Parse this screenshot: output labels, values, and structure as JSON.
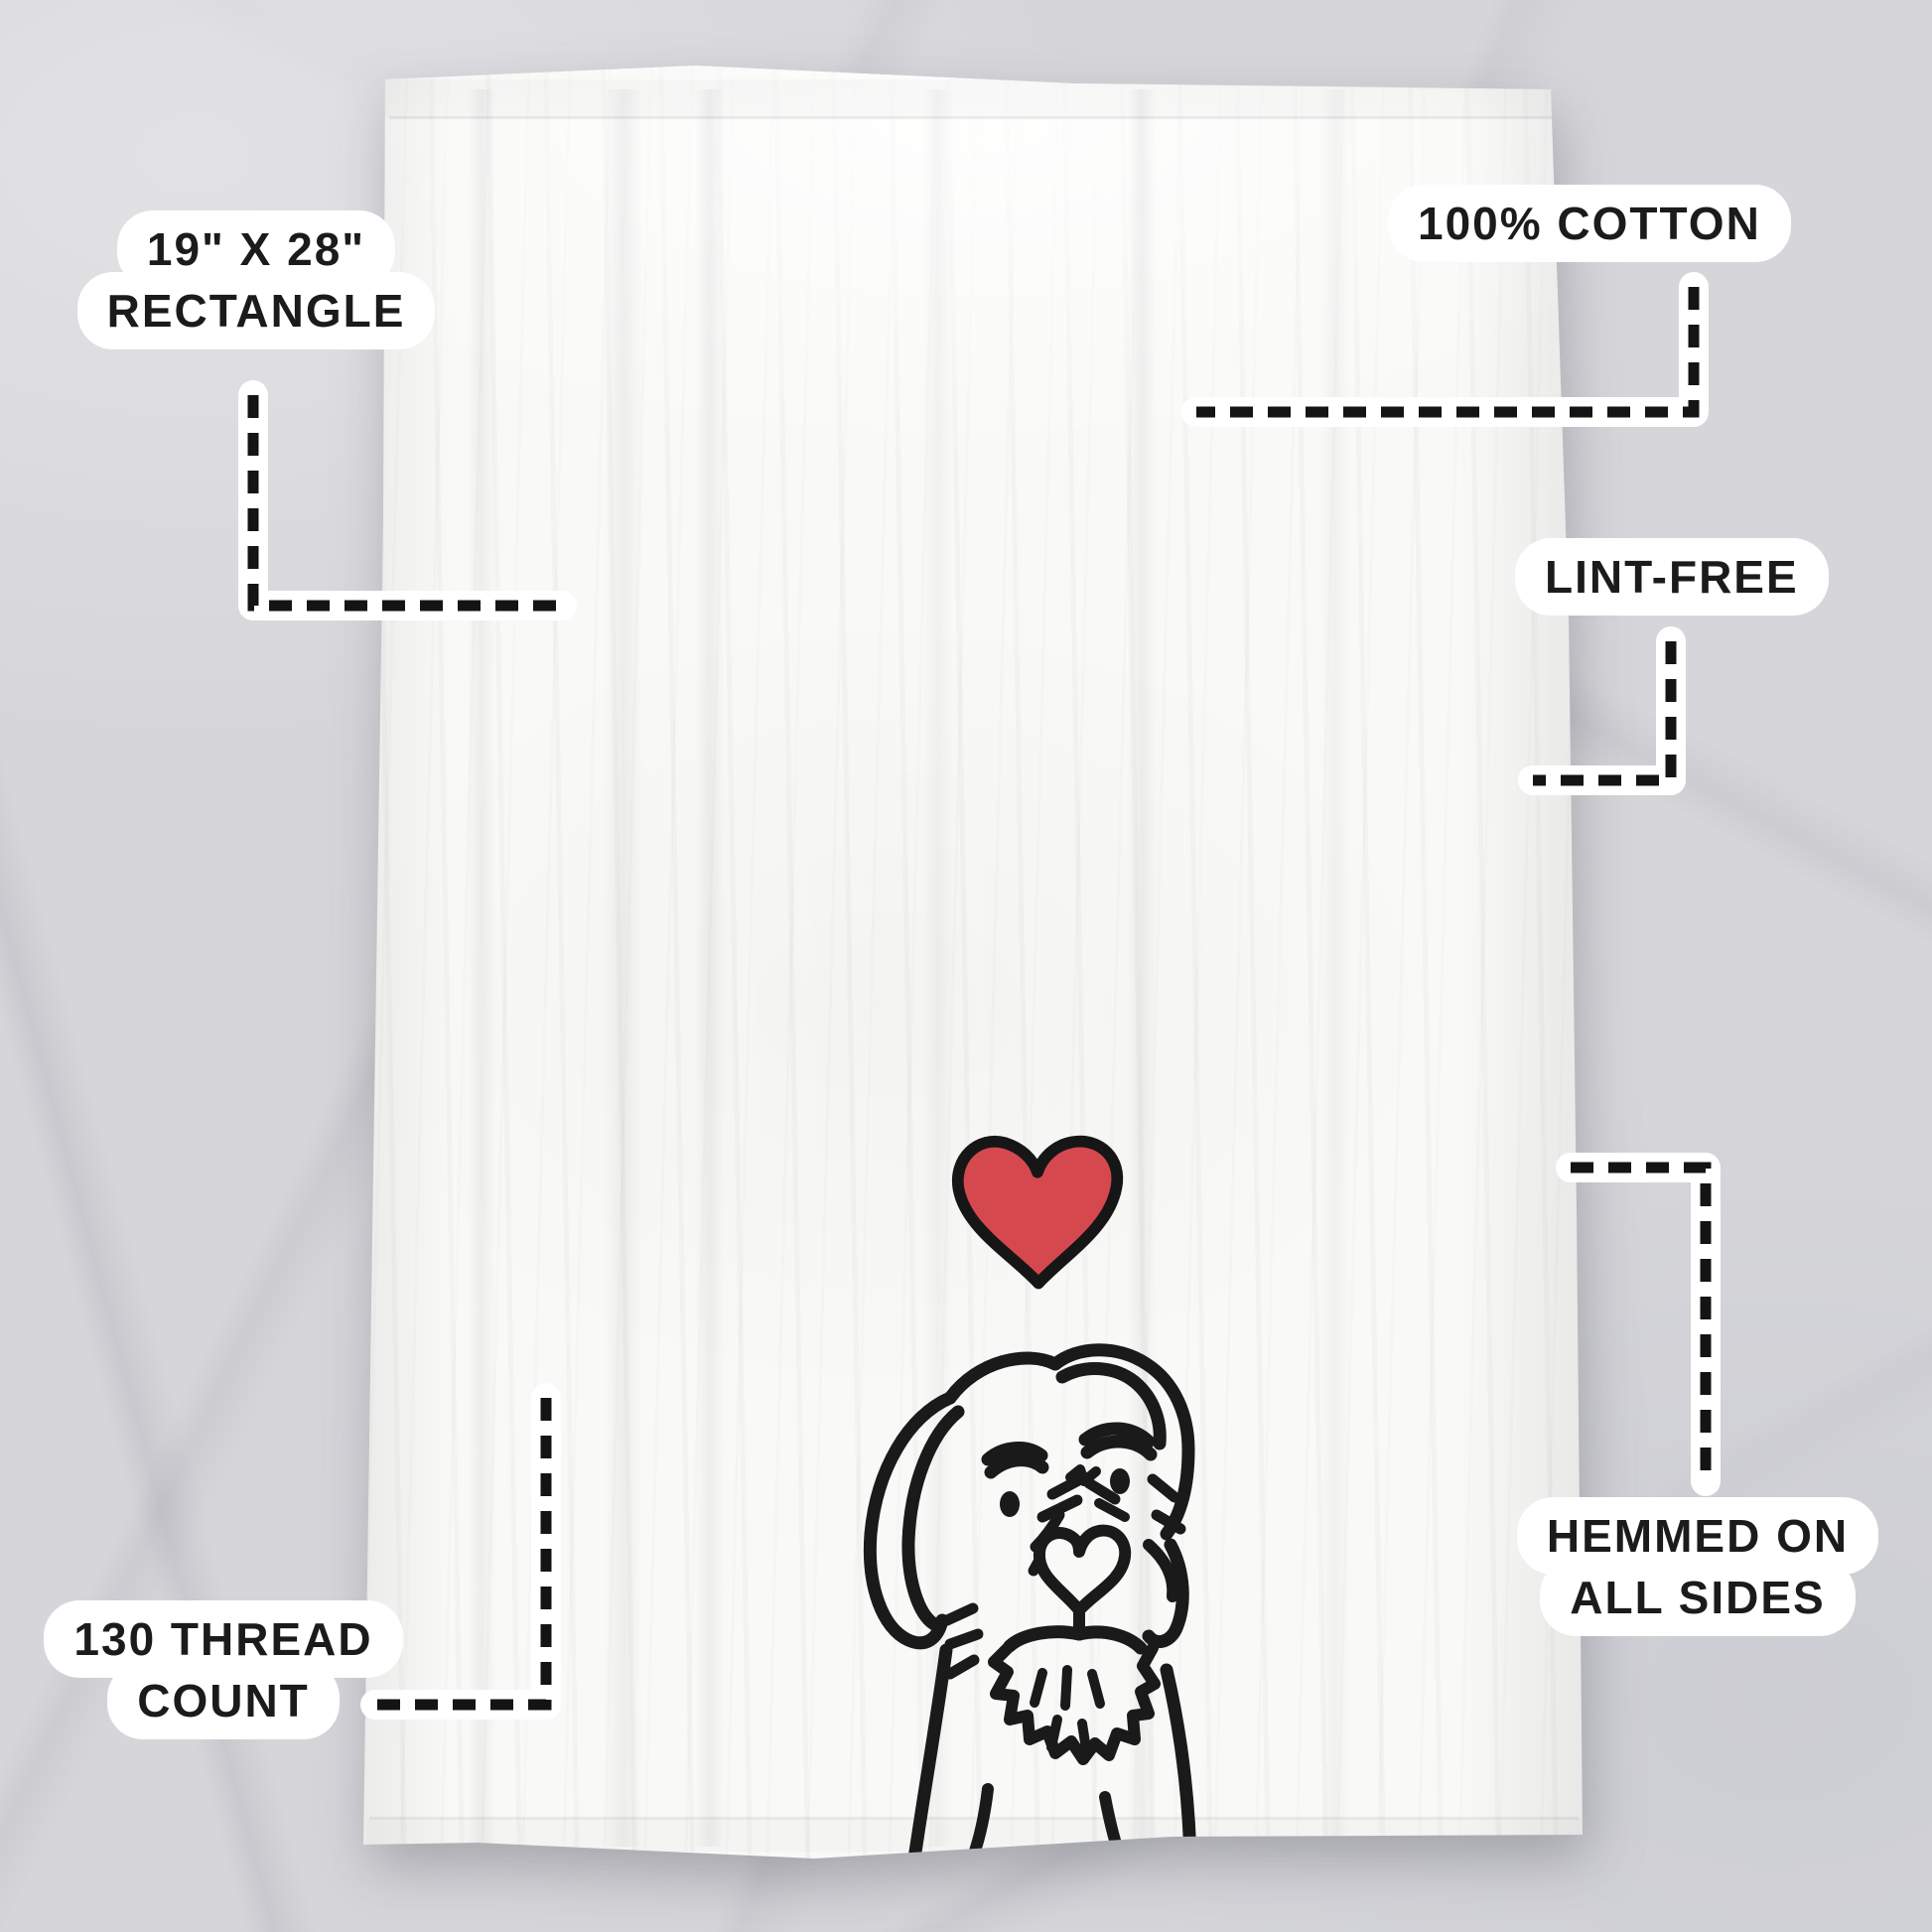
{
  "callouts": {
    "size": {
      "line1": "19\" X 28\"",
      "line2": "RECTANGLE"
    },
    "material": {
      "label": "100% COTTON"
    },
    "lint": {
      "label": "LINT-FREE"
    },
    "hemmed": {
      "line1": "HEMMED ON",
      "line2": "ALL SIDES"
    },
    "thread": {
      "line1": "130 THREAD",
      "line2": "COUNT"
    }
  },
  "design": {
    "heart_icon": "red-love-heart",
    "dog_illustration": "wirehaired-dog-with-heart-nose",
    "heart_color": "#d5494e",
    "line_color": "#1a1a1a"
  },
  "palette": {
    "background_marble": "#d6d6da",
    "towel_white": "#f9f9f7",
    "callout_pill": "#ffffff",
    "callout_text": "#1b1b1b"
  }
}
